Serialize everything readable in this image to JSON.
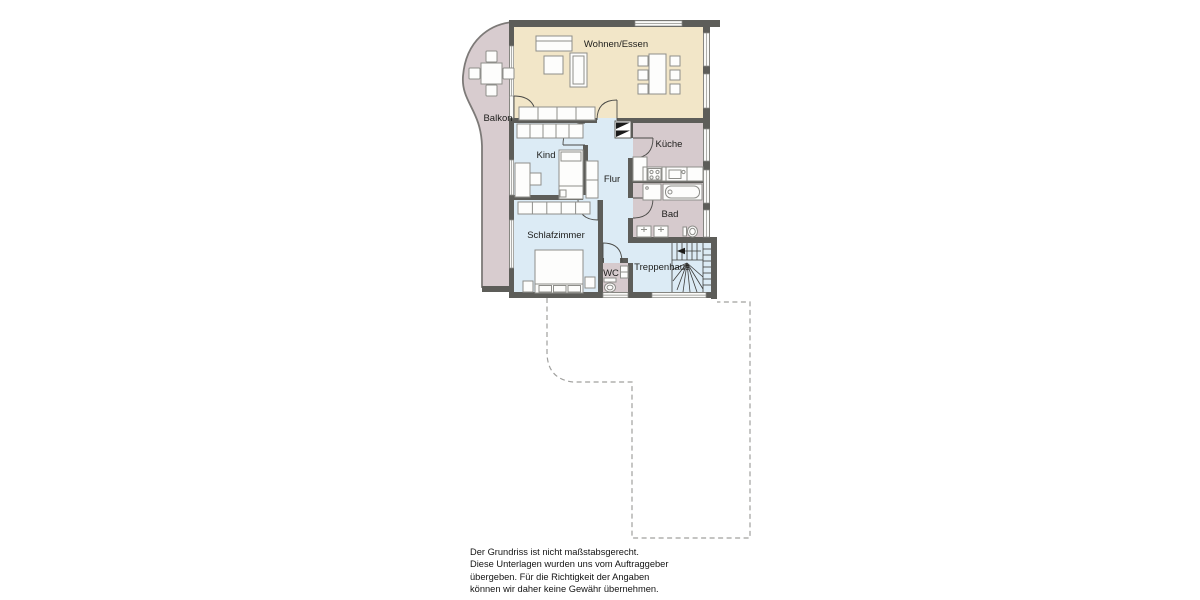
{
  "plan": {
    "rooms": {
      "wohnen_essen": {
        "label": "Wohnen/Essen"
      },
      "balkon": {
        "label": "Balkon"
      },
      "kind": {
        "label": "Kind"
      },
      "flur": {
        "label": "Flur"
      },
      "kueche": {
        "label": "Küche"
      },
      "bad": {
        "label": "Bad"
      },
      "schlafzimmer": {
        "label": "Schlafzimmer"
      },
      "wc": {
        "label": "WC"
      },
      "treppenhaus": {
        "label": "Treppenhaus"
      }
    },
    "colors": {
      "living_area": "#f2e6c8",
      "bedroom_area": "#dcebf5",
      "service_area": "#d6cacd",
      "balcony_area": "#d8cccf",
      "wall": "#5d5d59",
      "outline_dashed": "#a0a09e"
    }
  },
  "disclaimer": {
    "lines": [
      "Der Grundriss ist nicht maßstabsgerecht.",
      "Diese Unterlagen wurden uns vom Auftraggeber",
      "übergeben. Für die Richtigkeit der Angaben",
      "können wir daher keine Gewähr übernehmen."
    ]
  }
}
